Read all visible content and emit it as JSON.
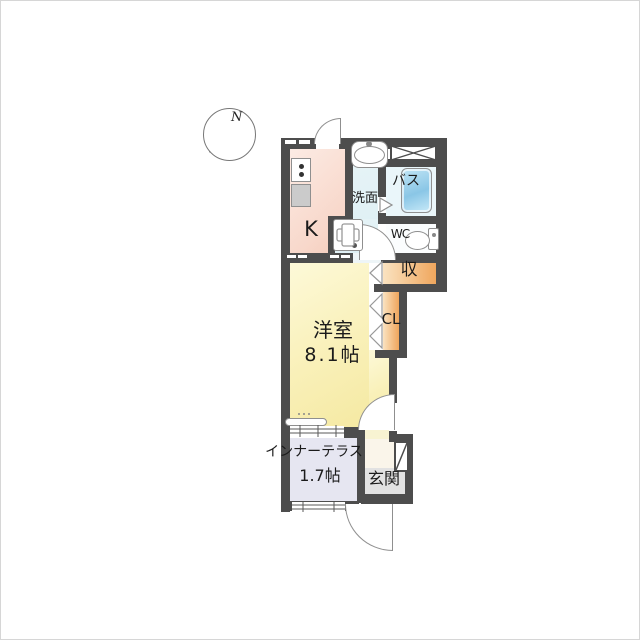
{
  "compass": {
    "north_label": "N"
  },
  "rooms": {
    "kitchen": {
      "label": "K"
    },
    "washroom": {
      "label": "洗面"
    },
    "bath": {
      "label": "バス"
    },
    "wc": {
      "label": "WC"
    },
    "storage": {
      "label": "収"
    },
    "closet": {
      "label": "CL"
    },
    "western_room": {
      "label": "洋室",
      "size": "8.1帖"
    },
    "inner_terrace": {
      "label": "インナーテラス",
      "size": "1.7帖"
    },
    "entrance": {
      "label": "玄関"
    }
  },
  "fixtures": [
    "stove",
    "kitchen-counter",
    "washbasin",
    "bathtub",
    "toilet",
    "washer-pan",
    "void-cross-box",
    "shoe-cabinet",
    "counter-shelf",
    "hinged-doors",
    "folding-closet-doors",
    "sliding-windows"
  ],
  "colors": {
    "wall": "#4d4d4d",
    "kitchen_floor": "#f8d8cb",
    "washroom_floor": "#ddeff4",
    "bath_floor": "#eaf6fa",
    "tub_blue": "#8ac6e6",
    "wc_floor": "#fbfdfe",
    "storage_orange": "#efa55b",
    "storage_orange_light": "#fae3c1",
    "room_yellow": "#f9f0b8",
    "terrace_lavender": "#e6e6f1",
    "entrance_gray": "#e2e2e2",
    "hall_cream": "#faf5ea"
  }
}
